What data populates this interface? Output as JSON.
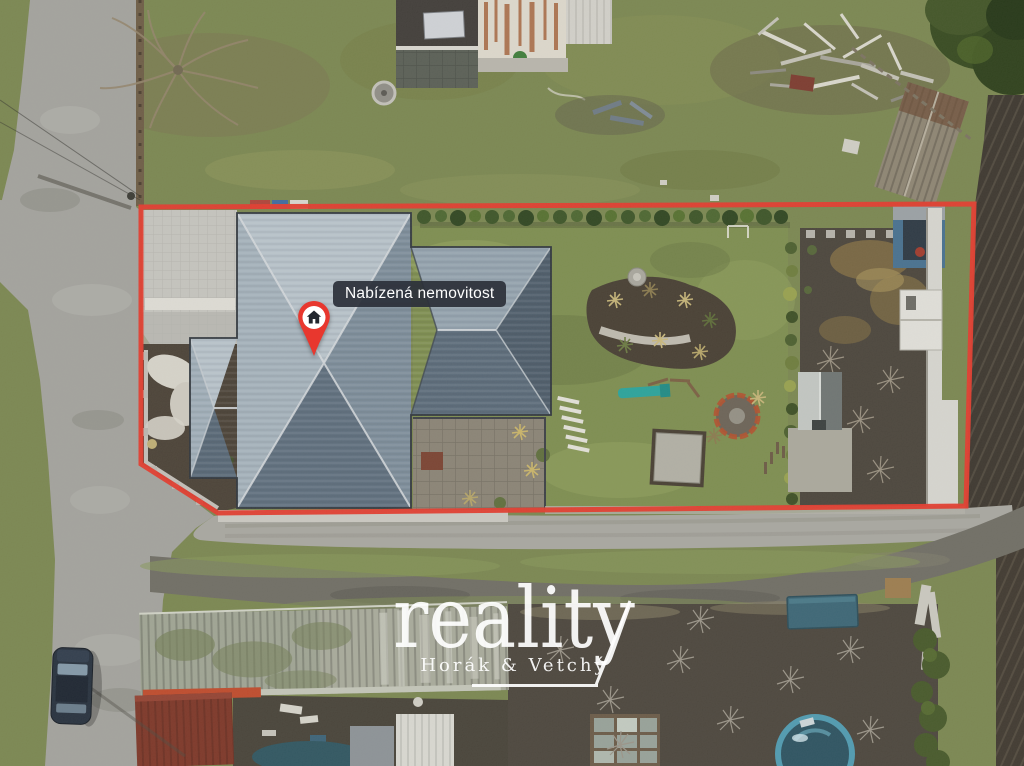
{
  "map_overlay": {
    "property_label": "Nabízená nemovitost",
    "pin_icon": "house-pin-icon"
  },
  "watermark": {
    "brand": "reality",
    "subtitle": "Horák & Vetchý"
  },
  "colors": {
    "outline_red": "#e23b2e",
    "pin_red": "#e8372e",
    "label_bg": "rgba(44,48,58,0.93)",
    "label_text": "#ffffff",
    "watermark_color": "rgba(255,255,255,0.92)"
  }
}
